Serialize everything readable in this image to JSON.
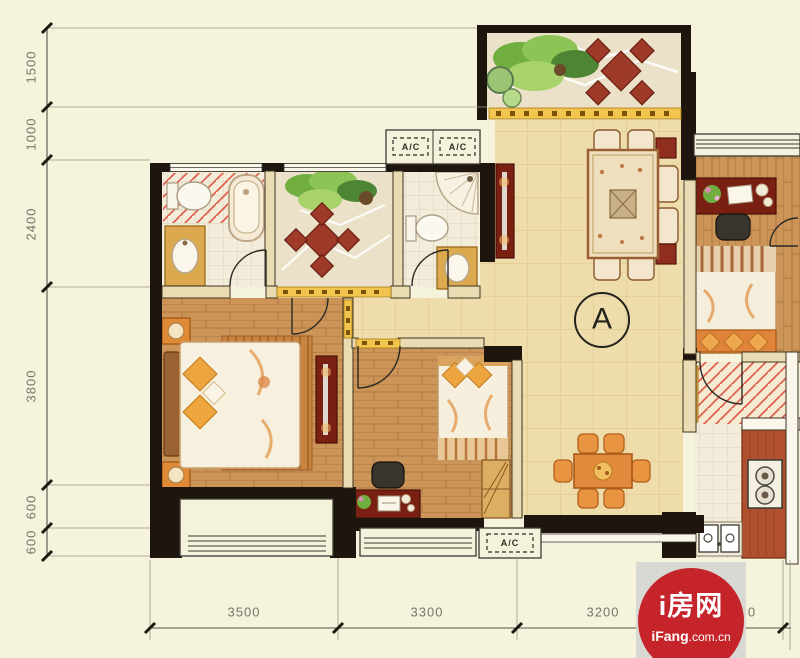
{
  "plan": {
    "type": "apartment-floor-plan"
  },
  "dimensions": {
    "left": [
      {
        "value": "1500"
      },
      {
        "value": "1000"
      },
      {
        "value": "2400"
      },
      {
        "value": "3800"
      },
      {
        "value": "600"
      },
      {
        "value": "600"
      }
    ],
    "bottom": [
      {
        "value": "3500"
      },
      {
        "value": "3300"
      },
      {
        "value": "3200"
      },
      {
        "value": "0"
      }
    ]
  },
  "labels": {
    "unit": "A",
    "ac_top_left": "A/C",
    "ac_top_right": "A/C",
    "ac_bottom": "A/C"
  },
  "logo": {
    "brand": "i房网",
    "domain_bold": "iFang",
    "domain_rest": ".com.cn"
  },
  "colors": {
    "background": "#f6f3dd",
    "wall": "#1d150e",
    "wall_light": "#e9dcb2",
    "wood": "#cf9a5e",
    "tile": "#eedcab",
    "hatch": "#e0614e",
    "gold": "#f2c54e",
    "furniture_red": "#7a2013",
    "logo_red": "#c5242b"
  }
}
